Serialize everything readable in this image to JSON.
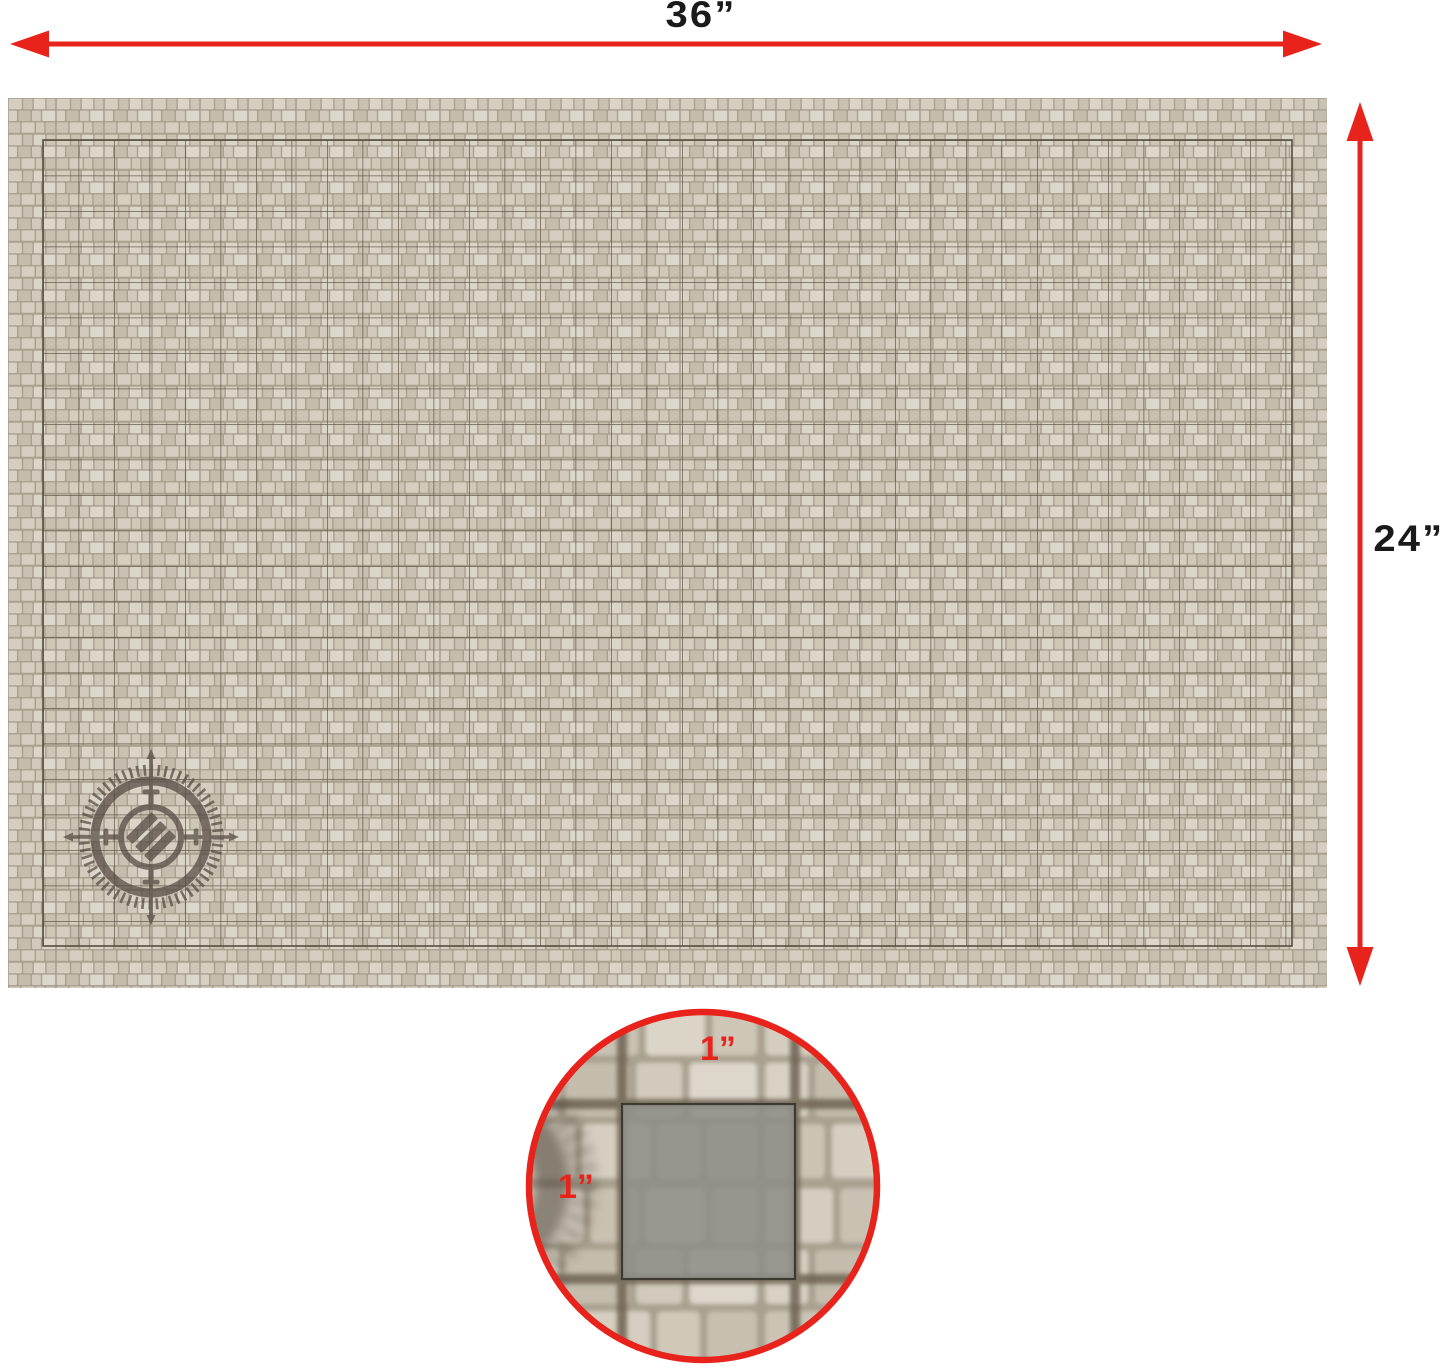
{
  "diagram": {
    "kind": "battle-mat-dimension-diagram",
    "dimensions": {
      "width_label": "36”",
      "height_label": "24”"
    },
    "mat": {
      "grid_columns": 36,
      "grid_rows": 24,
      "square_size_label": "1”",
      "logo_icon": "compass-crosshair-emblem"
    },
    "inset": {
      "top_label": "1”",
      "left_label": "1”"
    },
    "colors": {
      "arrow_red": "#e8231c",
      "label_black": "#1a1a1a",
      "mortar": "#a9a090",
      "stone_light": "#dbd5c8",
      "stone_mid": "#cfc7b8",
      "grid_line": "#564d3e",
      "logo_brown": "#544940",
      "inset_square_fill": "#8f8f88",
      "background": "#ffffff"
    }
  }
}
